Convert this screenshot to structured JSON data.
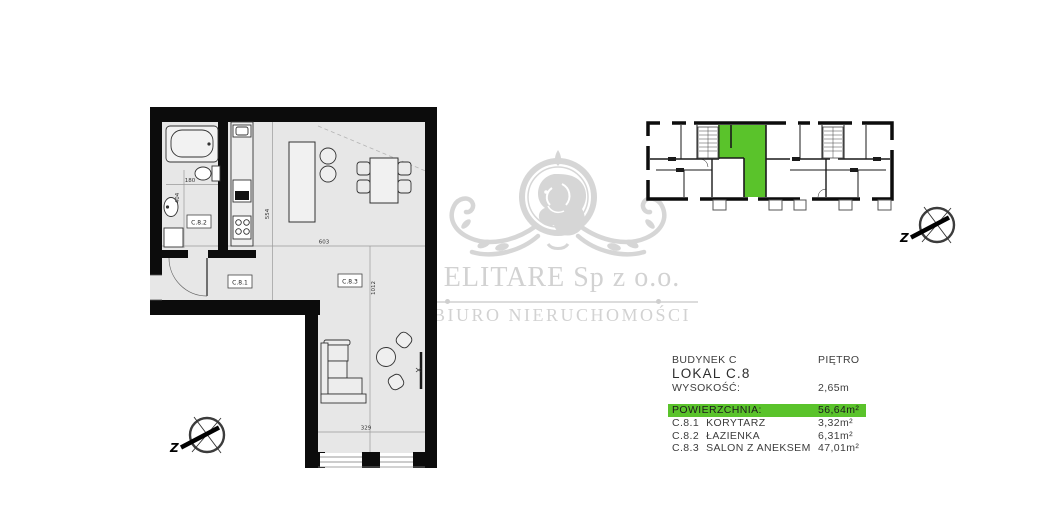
{
  "floor_plan": {
    "room_labels": {
      "c81": "C.8.1",
      "c82": "C.8.2",
      "c83": "C.8.3"
    },
    "dimensions": {
      "d180": "180",
      "d404": "404",
      "d554": "554",
      "d603": "603",
      "d1012": "1012",
      "d329": "329"
    }
  },
  "compass": {
    "west_label": "Z"
  },
  "watermark": {
    "company": "ELITARE Sp z o.o.",
    "subtitle": "BIURO NIERUCHOMOŚCI"
  },
  "info_panel": {
    "building_label": "BUDYNEK C",
    "floor_label": "PIĘTRO",
    "unit_label": "LOKAL C.8",
    "height_label": "WYSOKOŚĆ:",
    "height_value": "2,65m",
    "area_label": "POWIERZCHNIA:",
    "area_value": "56,64m²",
    "rooms": [
      {
        "code": "C.8.1",
        "name": "KORYTARZ",
        "area": "3,32m²"
      },
      {
        "code": "C.8.2",
        "name": "ŁAZIENKA",
        "area": "6,31m²"
      },
      {
        "code": "C.8.3",
        "name": "SALON Z ANEKSEM",
        "area": "47,01m²"
      }
    ]
  },
  "colors": {
    "highlight_green": "#5ac32b",
    "watermark_gray": "#d2d2d2",
    "floor_fill": "#e7e7e7",
    "wall_black": "#0c0c0c"
  }
}
